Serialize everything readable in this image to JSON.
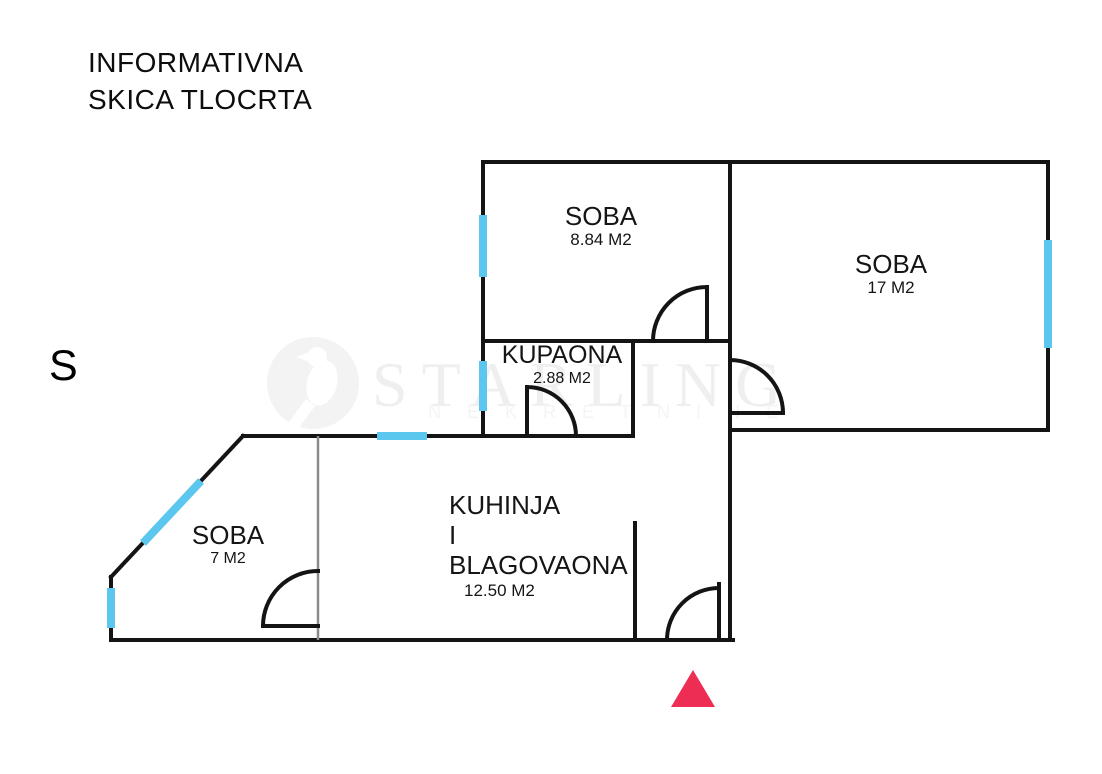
{
  "header": {
    "title_line1": "INFORMATIVNA",
    "title_line2": "SKICA TLOCRTA"
  },
  "compass": {
    "north_label": "S"
  },
  "watermark": {
    "brand": "STARLING",
    "subtitle": "NEKRETNINE",
    "logo_icon": "bird-silhouette"
  },
  "rooms": {
    "soba_top": {
      "name": "SOBA",
      "area": "8.84 M2"
    },
    "soba_right": {
      "name": "SOBA",
      "area": "17 M2"
    },
    "kupaona": {
      "name": "KUPAONA",
      "area": "2.88 M2"
    },
    "kuhinja": {
      "name_line1": "KUHINJA",
      "name_line2": "I",
      "name_line3": "BLAGOVAONA",
      "area": "12.50 M2"
    },
    "soba_left": {
      "name": "SOBA",
      "area": "7 M2"
    }
  },
  "markers": {
    "entrance": "entrance-triangle"
  },
  "colors": {
    "wall": "#141414",
    "window": "#5BC6EE",
    "partition": "#8A8A8A",
    "entrance_marker": "#EE2D55",
    "watermark_text": "#EFEFEF"
  }
}
